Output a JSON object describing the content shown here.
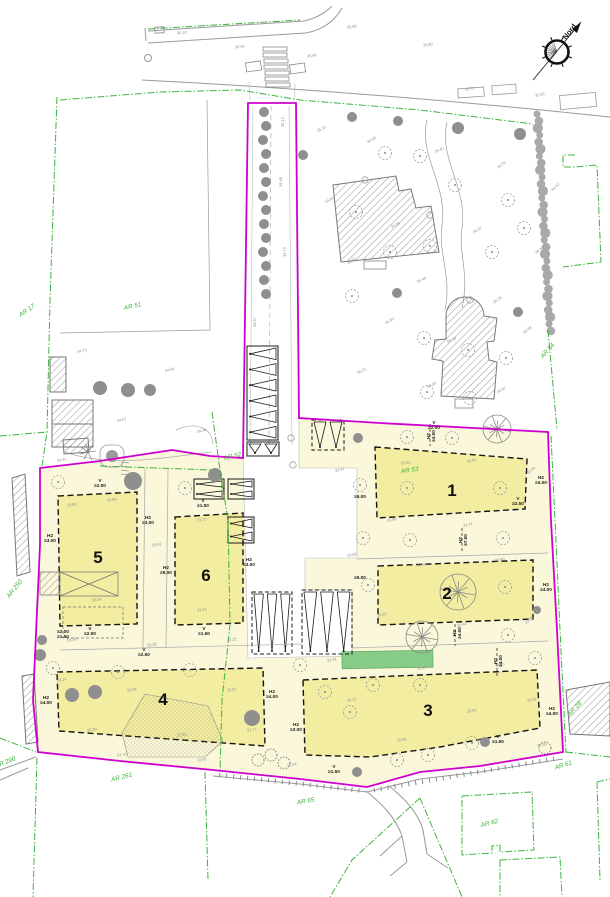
{
  "drawing": {
    "north_label": "Nord",
    "colors": {
      "site_boundary_magenta": "#cf00cf",
      "parcel_green": "#3cb43c",
      "site_fill": "#faf7da",
      "lot_fill": "#f3eda1",
      "grass_green": "#86cb86",
      "line_gray": "#9a9a9a",
      "text_gray": "#8f8f8f",
      "black": "#1b1b1b"
    },
    "lots": [
      {
        "number": "1",
        "x": 452,
        "y": 496
      },
      {
        "number": "2",
        "x": 447,
        "y": 599
      },
      {
        "number": "3",
        "x": 428,
        "y": 716
      },
      {
        "number": "4",
        "x": 163,
        "y": 705
      },
      {
        "number": "5",
        "x": 98,
        "y": 563
      },
      {
        "number": "6",
        "x": 206,
        "y": 581
      }
    ],
    "parcel_labels": [
      {
        "text": "AR 17",
        "x": 28,
        "y": 312,
        "rot": -35
      },
      {
        "text": "AR 51",
        "x": 133,
        "y": 308,
        "rot": -12
      },
      {
        "text": "AR 54",
        "x": 549,
        "y": 352,
        "rot": -48
      },
      {
        "text": "AR 52",
        "x": 233,
        "y": 458,
        "rot": -14
      },
      {
        "text": "AR 53",
        "x": 410,
        "y": 472,
        "rot": -8
      },
      {
        "text": "AR 250",
        "x": 16,
        "y": 590,
        "rot": -52
      },
      {
        "text": "AR 261",
        "x": 122,
        "y": 779,
        "rot": -14
      },
      {
        "text": "AR 290",
        "x": 6,
        "y": 764,
        "rot": -22
      },
      {
        "text": "AR 65",
        "x": 306,
        "y": 803,
        "rot": -10
      },
      {
        "text": "AR 61",
        "x": 564,
        "y": 767,
        "rot": -18
      },
      {
        "text": "AR 62",
        "x": 490,
        "y": 825,
        "rot": -15
      },
      {
        "text": "AR 28",
        "x": 576,
        "y": 710,
        "rot": -48
      }
    ],
    "limit_labels": [
      {
        "lines": [
          "H2",
          "≥4.00"
        ],
        "x": 430,
        "y": 436,
        "rot": -90
      },
      {
        "lines": [
          "H2",
          "≥4.00"
        ],
        "x": 541,
        "y": 479,
        "rot": 0
      },
      {
        "lines": [
          "≥5.00"
        ],
        "x": 360,
        "y": 498,
        "rot": 0
      },
      {
        "lines": [
          "H2",
          "≥7.00"
        ],
        "x": 462,
        "y": 540,
        "rot": -90
      },
      {
        "lines": [
          "≥5.00"
        ],
        "x": 360,
        "y": 579,
        "rot": 0
      },
      {
        "lines": [
          "H2",
          "≥4.00"
        ],
        "x": 546,
        "y": 586,
        "rot": 0
      },
      {
        "lines": [
          "H2",
          "≥4.00"
        ],
        "x": 456,
        "y": 633,
        "rot": -90
      },
      {
        "lines": [
          "H2",
          "≥4.00"
        ],
        "x": 497,
        "y": 661,
        "rot": -90
      },
      {
        "lines": [
          "H2",
          "≥4.00"
        ],
        "x": 552,
        "y": 710,
        "rot": 0
      },
      {
        "lines": [
          "H2",
          "≥3.00"
        ],
        "x": 296,
        "y": 726,
        "rot": 0
      },
      {
        "lines": [
          "H2",
          "≥4.00"
        ],
        "x": 46,
        "y": 699,
        "rot": 0
      },
      {
        "lines": [
          "H2",
          "≥4.00"
        ],
        "x": 272,
        "y": 693,
        "rot": 0
      },
      {
        "lines": [
          "H2",
          "≥3.00"
        ],
        "x": 50,
        "y": 537,
        "rot": 0
      },
      {
        "lines": [
          "H2",
          "≥3.00"
        ],
        "x": 148,
        "y": 519,
        "rot": 0
      },
      {
        "lines": [
          "H2",
          "≥5.00"
        ],
        "x": 166,
        "y": 569,
        "rot": 0
      },
      {
        "lines": [
          "H2",
          "≥3.00"
        ],
        "x": 249,
        "y": 561,
        "rot": 0
      },
      {
        "lines": [
          "V",
          "≥2.00"
        ],
        "x": 100,
        "y": 482,
        "rot": 0
      },
      {
        "lines": [
          "V",
          "≥1.50"
        ],
        "x": 203,
        "y": 502,
        "rot": 0
      },
      {
        "lines": [
          "V",
          "≥2.00"
        ],
        "x": 90,
        "y": 630,
        "rot": 0
      },
      {
        "lines": [
          "V",
          "≥1.50"
        ],
        "x": 204,
        "y": 630,
        "rot": 0
      },
      {
        "lines": [
          "V",
          "≥2.00"
        ],
        "x": 434,
        "y": 424,
        "rot": 0
      },
      {
        "lines": [
          "V",
          "≥1.50"
        ],
        "x": 498,
        "y": 738,
        "rot": 0
      },
      {
        "lines": [
          "V",
          "≥1.50"
        ],
        "x": 334,
        "y": 768,
        "rot": 0
      },
      {
        "lines": [
          "V",
          "≥2.50"
        ],
        "x": 144,
        "y": 651,
        "rot": 0
      },
      {
        "lines": [
          "≥2.00",
          "≥1.50"
        ],
        "x": 63,
        "y": 633,
        "rot": 0
      },
      {
        "lines": [
          "V",
          "≥2.50"
        ],
        "x": 518,
        "y": 500,
        "rot": 0
      }
    ],
    "spot_elevations": [
      {
        "v": "36.10",
        "x": 182,
        "y": 34,
        "rot": -6
      },
      {
        "v": "36.04",
        "x": 240,
        "y": 48,
        "rot": -6
      },
      {
        "v": "35.96",
        "x": 312,
        "y": 57,
        "rot": -8
      },
      {
        "v": "35.89",
        "x": 352,
        "y": 28,
        "rot": -8
      },
      {
        "v": "35.80",
        "x": 428,
        "y": 46,
        "rot": -8
      },
      {
        "v": "35.71",
        "x": 470,
        "y": 90,
        "rot": -10
      },
      {
        "v": "35.58",
        "x": 540,
        "y": 96,
        "rot": -12
      },
      {
        "v": "35.12",
        "x": 322,
        "y": 130,
        "rot": -32
      },
      {
        "v": "34.98",
        "x": 372,
        "y": 141,
        "rot": -30
      },
      {
        "v": "34.87",
        "x": 440,
        "y": 151,
        "rot": -22
      },
      {
        "v": "34.76",
        "x": 502,
        "y": 166,
        "rot": -34
      },
      {
        "v": "34.62",
        "x": 556,
        "y": 188,
        "rot": -42
      },
      {
        "v": "34.81",
        "x": 330,
        "y": 201,
        "rot": -30
      },
      {
        "v": "34.66",
        "x": 396,
        "y": 226,
        "rot": -26
      },
      {
        "v": "34.57",
        "x": 478,
        "y": 231,
        "rot": -30
      },
      {
        "v": "34.44",
        "x": 540,
        "y": 251,
        "rot": -36
      },
      {
        "v": "34.52",
        "x": 352,
        "y": 262,
        "rot": -28
      },
      {
        "v": "34.40",
        "x": 422,
        "y": 281,
        "rot": -24
      },
      {
        "v": "34.28",
        "x": 498,
        "y": 301,
        "rot": -34
      },
      {
        "v": "34.30",
        "x": 390,
        "y": 322,
        "rot": -30
      },
      {
        "v": "34.19",
        "x": 452,
        "y": 341,
        "rot": -24
      },
      {
        "v": "34.08",
        "x": 528,
        "y": 331,
        "rot": -40
      },
      {
        "v": "34.21",
        "x": 362,
        "y": 372,
        "rot": -28
      },
      {
        "v": "34.05",
        "x": 432,
        "y": 386,
        "rot": -24
      },
      {
        "v": "33.97",
        "x": 502,
        "y": 391,
        "rot": -30
      },
      {
        "v": "34.73",
        "x": 82,
        "y": 352,
        "rot": -10
      },
      {
        "v": "34.66",
        "x": 170,
        "y": 371,
        "rot": -14
      },
      {
        "v": "34.57",
        "x": 122,
        "y": 421,
        "rot": -12
      },
      {
        "v": "34.49",
        "x": 202,
        "y": 432,
        "rot": -14
      },
      {
        "v": "34.41",
        "x": 62,
        "y": 461,
        "rot": -10
      },
      {
        "v": "34.57",
        "x": 256,
        "y": 322,
        "rot": -88
      },
      {
        "v": "34.70",
        "x": 286,
        "y": 252,
        "rot": -88
      },
      {
        "v": "34.85",
        "x": 282,
        "y": 182,
        "rot": -88
      },
      {
        "v": "35.10",
        "x": 284,
        "y": 122,
        "rot": -88
      },
      {
        "v": "33.97",
        "x": 340,
        "y": 471,
        "rot": -12
      },
      {
        "v": "33.91",
        "x": 406,
        "y": 464,
        "rot": -8
      },
      {
        "v": "33.87",
        "x": 472,
        "y": 462,
        "rot": -12
      },
      {
        "v": "33.81",
        "x": 532,
        "y": 471,
        "rot": -38
      },
      {
        "v": "33.80",
        "x": 392,
        "y": 521,
        "rot": -10
      },
      {
        "v": "33.74",
        "x": 468,
        "y": 526,
        "rot": -10
      },
      {
        "v": "33.69",
        "x": 352,
        "y": 556,
        "rot": -10
      },
      {
        "v": "33.64",
        "x": 422,
        "y": 566,
        "rot": -8
      },
      {
        "v": "33.60",
        "x": 500,
        "y": 561,
        "rot": -10
      },
      {
        "v": "33.50",
        "x": 382,
        "y": 616,
        "rot": -10
      },
      {
        "v": "33.44",
        "x": 462,
        "y": 626,
        "rot": -10
      },
      {
        "v": "33.38",
        "x": 530,
        "y": 621,
        "rot": -38
      },
      {
        "v": "33.31",
        "x": 332,
        "y": 661,
        "rot": -10
      },
      {
        "v": "33.26",
        "x": 422,
        "y": 669,
        "rot": -10
      },
      {
        "v": "33.20",
        "x": 500,
        "y": 666,
        "rot": -10
      },
      {
        "v": "33.12",
        "x": 352,
        "y": 701,
        "rot": -10
      },
      {
        "v": "33.00",
        "x": 472,
        "y": 712,
        "rot": -10
      },
      {
        "v": "32.92",
        "x": 532,
        "y": 701,
        "rot": -10
      },
      {
        "v": "32.83",
        "x": 402,
        "y": 741,
        "rot": -10
      },
      {
        "v": "32.74",
        "x": 482,
        "y": 741,
        "rot": -10
      },
      {
        "v": "32.58",
        "x": 542,
        "y": 746,
        "rot": -10
      },
      {
        "v": "33.89",
        "x": 72,
        "y": 506,
        "rot": -8
      },
      {
        "v": "33.84",
        "x": 112,
        "y": 501,
        "rot": -8
      },
      {
        "v": "33.70",
        "x": 202,
        "y": 521,
        "rot": -8
      },
      {
        "v": "33.62",
        "x": 157,
        "y": 546,
        "rot": -8
      },
      {
        "v": "33.54",
        "x": 97,
        "y": 601,
        "rot": -8
      },
      {
        "v": "33.43",
        "x": 202,
        "y": 611,
        "rot": -8
      },
      {
        "v": "33.36",
        "x": 72,
        "y": 641,
        "rot": -8
      },
      {
        "v": "33.28",
        "x": 152,
        "y": 646,
        "rot": -8
      },
      {
        "v": "33.22",
        "x": 232,
        "y": 641,
        "rot": -8
      },
      {
        "v": "33.14",
        "x": 62,
        "y": 681,
        "rot": -8
      },
      {
        "v": "33.08",
        "x": 132,
        "y": 691,
        "rot": -8
      },
      {
        "v": "32.97",
        "x": 232,
        "y": 691,
        "rot": -8
      },
      {
        "v": "32.90",
        "x": 92,
        "y": 731,
        "rot": -8
      },
      {
        "v": "32.82",
        "x": 182,
        "y": 736,
        "rot": -8
      },
      {
        "v": "32.77",
        "x": 252,
        "y": 731,
        "rot": -8
      },
      {
        "v": "32.70",
        "x": 122,
        "y": 756,
        "rot": -8
      },
      {
        "v": "32.62",
        "x": 202,
        "y": 761,
        "rot": -8
      },
      {
        "v": "32.54",
        "x": 292,
        "y": 766,
        "rot": -8
      }
    ],
    "vegetation": {
      "filled_trees": [
        [
          264,
          112,
          5
        ],
        [
          266,
          126,
          5
        ],
        [
          263,
          140,
          5
        ],
        [
          266,
          154,
          5
        ],
        [
          264,
          168,
          5
        ],
        [
          266,
          182,
          5
        ],
        [
          263,
          196,
          5
        ],
        [
          266,
          210,
          5
        ],
        [
          264,
          224,
          5
        ],
        [
          266,
          238,
          5
        ],
        [
          263,
          252,
          5
        ],
        [
          266,
          266,
          5
        ],
        [
          264,
          280,
          5
        ],
        [
          266,
          294,
          5
        ],
        [
          352,
          117,
          5
        ],
        [
          398,
          121,
          5
        ],
        [
          458,
          128,
          6
        ],
        [
          520,
          134,
          6
        ],
        [
          303,
          155,
          5
        ],
        [
          397,
          293,
          5
        ],
        [
          518,
          312,
          5
        ],
        [
          100,
          388,
          7
        ],
        [
          128,
          390,
          7
        ],
        [
          150,
          390,
          6
        ],
        [
          133,
          481,
          9
        ],
        [
          215,
          475,
          7
        ],
        [
          358,
          438,
          5
        ],
        [
          40,
          655,
          6
        ],
        [
          72,
          695,
          7
        ],
        [
          95,
          692,
          7
        ],
        [
          252,
          718,
          8
        ],
        [
          42,
          640,
          5
        ],
        [
          357,
          772,
          5
        ],
        [
          485,
          742,
          5
        ],
        [
          537,
          610,
          4
        ]
      ],
      "crown_trees": [
        [
          385,
          153
        ],
        [
          420,
          156
        ],
        [
          455,
          185
        ],
        [
          508,
          200
        ],
        [
          524,
          228
        ],
        [
          492,
          252
        ],
        [
          430,
          246
        ],
        [
          356,
          212
        ],
        [
          390,
          252
        ],
        [
          352,
          296
        ],
        [
          424,
          338
        ],
        [
          468,
          350
        ],
        [
          506,
          358
        ],
        [
          470,
          398
        ],
        [
          427,
          392
        ],
        [
          407,
          437
        ],
        [
          452,
          438
        ],
        [
          360,
          485
        ],
        [
          407,
          488
        ],
        [
          500,
          488
        ],
        [
          363,
          538
        ],
        [
          410,
          540
        ],
        [
          503,
          538
        ],
        [
          368,
          585
        ],
        [
          505,
          587
        ],
        [
          508,
          635
        ],
        [
          535,
          658
        ],
        [
          325,
          692
        ],
        [
          373,
          685
        ],
        [
          420,
          685
        ],
        [
          350,
          712
        ],
        [
          300,
          665
        ],
        [
          397,
          760
        ],
        [
          428,
          755
        ],
        [
          472,
          743
        ],
        [
          58,
          482
        ],
        [
          185,
          488
        ],
        [
          53,
          668
        ],
        [
          118,
          672
        ],
        [
          190,
          670
        ]
      ],
      "small_circles": [
        [
          291,
          438
        ],
        [
          293,
          465
        ],
        [
          365,
          180
        ],
        [
          430,
          215
        ],
        [
          470,
          300
        ]
      ],
      "segmented_trees": [
        [
          497,
          429,
          14
        ],
        [
          458,
          592,
          18
        ],
        [
          422,
          637,
          16
        ]
      ],
      "bushes": [
        [
          258,
          760
        ],
        [
          271,
          755
        ],
        [
          284,
          763
        ],
        [
          545,
          748
        ]
      ]
    }
  }
}
